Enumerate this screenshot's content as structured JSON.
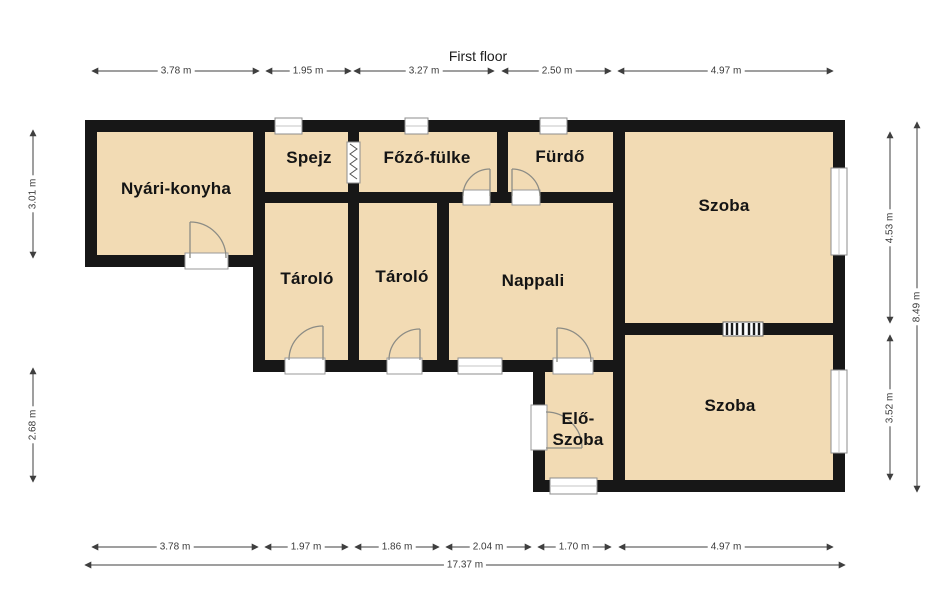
{
  "title": "First floor",
  "rooms": {
    "nyari_konyha": "Nyári-konyha",
    "spejz": "Spejz",
    "fozo_fulke": "Főző-fülke",
    "furdo": "Fürdő",
    "szoba_top": "Szoba",
    "tarolo_1": "Tároló",
    "tarolo_2": "Tároló",
    "nappali": "Nappali",
    "elo_szoba_line1": "Elő-",
    "elo_szoba_line2": "Szoba",
    "szoba_bottom": "Szoba"
  },
  "dimensions": {
    "top": [
      "3.78 m",
      "1.95 m",
      "3.27 m",
      "2.50 m",
      "4.97 m"
    ],
    "bottom": [
      "3.78 m",
      "1.97 m",
      "1.86 m",
      "2.04 m",
      "1.70 m",
      "4.97 m"
    ],
    "bottom_total": "17.37 m",
    "left": [
      "3.01 m",
      "2.68 m"
    ],
    "right": [
      "4.53 m",
      "3.52 m"
    ],
    "right_total": "8.49 m"
  },
  "colors": {
    "room_fill": "#f2dbb4",
    "wall": "#171717",
    "dimension_line": "#3f3f3f",
    "window_border": "#8d8d8d",
    "door_arc": "#8c8c85"
  }
}
